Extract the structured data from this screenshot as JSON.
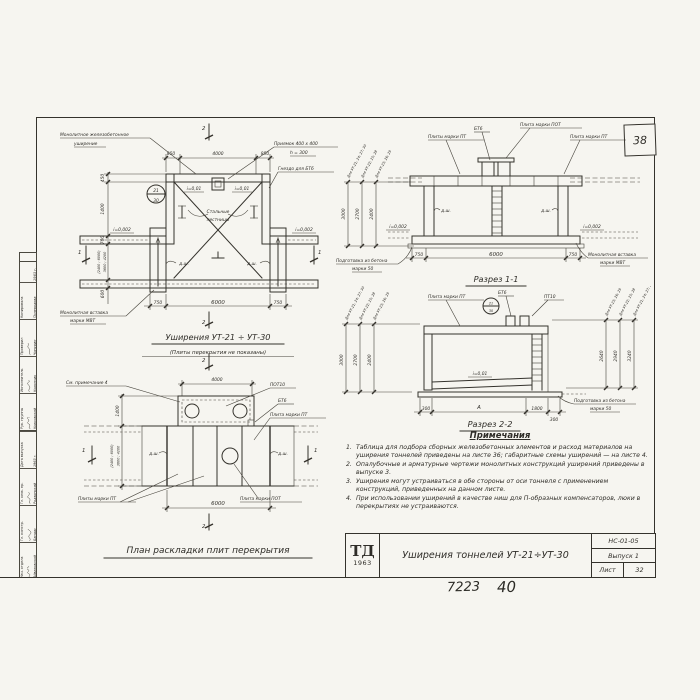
{
  "sheet": {
    "page_number": "38",
    "stamp_number_1": "7223",
    "stamp_number_2": "40"
  },
  "titleblock": {
    "logo": "ТД",
    "logo_year": "1963",
    "title": "Уширения тоннелей УТ-21÷УТ-30",
    "code": "НС-01-05",
    "issue": "Выпуск 1",
    "sheet_label": "Лист",
    "sheet_number": "32"
  },
  "stamp_sidebar": {
    "block_bottom": {
      "rows": [
        {
          "role": "Нач. отдела",
          "name": "Айвазовский"
        },
        {
          "role": "Гл. констр.",
          "name": "Бандас"
        },
        {
          "role": "Гл. инж. пр.",
          "name": "Родзинский"
        },
        {
          "role": "Дата выпуска",
          "name": "1963 г."
        }
      ]
    },
    "block_top": {
      "rows": [
        {
          "role": "Рук. группы",
          "name": "Красовский"
        },
        {
          "role": "Исполнитель",
          "name": "Корончик"
        },
        {
          "role": "Проверил",
          "name": "Чипурин"
        },
        {
          "role": "Копировала",
          "name": "Полеводова"
        }
      ],
      "year": "1963 г."
    }
  },
  "plan_top": {
    "title": "Уширения УТ-21 ÷ УТ-30",
    "subtitle": "(Плиты перекрытия не показаны)",
    "labels": {
      "monolithic_1": "Монолитное железобетонное",
      "monolithic_2": "уширение",
      "pit_1": "Приямок 400 х 400",
      "pit_2": "h = 300",
      "socket": "Гнездо для БТ6",
      "stairs_1": "Стальные",
      "stairs_2": "лестницы",
      "insert_1": "Монолитная вставка",
      "insert_2": "марки МВТ",
      "slope_a": "i=0,01",
      "slope_b": "i=0,01",
      "slope_c": "i=0,002",
      "slope_d": "i=0,002",
      "joint": "д.ш.",
      "mark_top": "21",
      "mark_bottom": "30"
    },
    "dims": {
      "top": [
        "850",
        "4000",
        "850"
      ],
      "bottom": [
        "750",
        "6000",
        "750"
      ],
      "left": [
        "450",
        "1400",
        "700",
        "(2400 ; 6000)",
        "3600 ; 4200",
        "600"
      ]
    },
    "marks": {
      "section_2": "2",
      "section_1": "1"
    }
  },
  "section_1": {
    "title": "Разрез 1-1",
    "labels": {
      "bt6": "БТ6",
      "plate_pot": "Плита марки ПОТ",
      "plates_pt": "Плиты марки ПТ",
      "plate_pt": "Плита марки ПТ",
      "prep_1": "Подготовка из бетона",
      "prep_2": "марки 50",
      "insert_1": "Монолитная вставка",
      "insert_2": "марки МВТ",
      "joint": "д.ш.",
      "slope": "i=0,002"
    },
    "dims": {
      "bottom": [
        "750",
        "6000",
        "750"
      ]
    },
    "height_dims": [
      {
        "for": "Для УТ-21; 24; 27; 30",
        "value": "3000"
      },
      {
        "for": "Для УТ-22; 25; 28",
        "value": "2700"
      },
      {
        "for": "Для УТ-23; 26; 29",
        "value": "2400"
      }
    ]
  },
  "section_2": {
    "title": "Разрез 2-2",
    "labels": {
      "plate_pt": "Плита марки ПТ",
      "bt6": "БТ6",
      "pt10": "ПТ10",
      "slope": "i=0,01",
      "prep_1": "Подготовка из бетона",
      "prep_2": "марки 50",
      "mark_top": "21",
      "mark_bottom": "30"
    },
    "dims": {
      "bottom": [
        "300",
        "А",
        "1800",
        "300"
      ]
    },
    "height_dims_left": [
      {
        "for": "Для УТ-21; 24; 27; 30",
        "value": "3000"
      },
      {
        "for": "Для УТ-22; 25; 28",
        "value": "2700"
      },
      {
        "for": "Для УТ-23; 26; 29",
        "value": "2400"
      }
    ],
    "height_dims_right": [
      {
        "for": "Для УТ-23; 26; 29",
        "value": "2640"
      },
      {
        "for": "Для УТ-22; 25; 28",
        "value": "2940"
      },
      {
        "for": "Для УТ-21; 24; 27; 30",
        "value": "3240"
      }
    ]
  },
  "plan_bottom": {
    "title": "План раскладки плит перекрытия",
    "labels": {
      "see_note": "См. примечание 4",
      "pot10": "ПОТ10",
      "bt6": "БТ6",
      "plate_pt": "Плита марки ПТ",
      "plates_pt": "Плиты марки ПТ",
      "plate_pot": "Плита марки ПОТ",
      "joint": "д.ш."
    },
    "dims": {
      "top": "4000",
      "bottom": "6000",
      "left": [
        "1400",
        "(2400 ; 6000)",
        "3600 ; 4200"
      ]
    },
    "marks": {
      "section_2": "2",
      "section_1": "1"
    }
  },
  "notes": {
    "heading": "Примечания",
    "items": [
      {
        "num": "1.",
        "text": "Таблица для подбора сборных железобетонных элементов и расход материалов на уширения тоннелей приведены на листе 36; габаритные схемы уширений — на листе 4."
      },
      {
        "num": "2.",
        "text": "Опалубочные и арматурные чертежи монолитных конструкций уширений приведены в выпуске 3."
      },
      {
        "num": "3.",
        "text": "Уширения могут устраиваться в обе стороны от оси тоннеля с применением конструкций, приведенных на данном листе."
      },
      {
        "num": "4.",
        "text": "При использовании уширений в качестве ниш для П-образных компенсаторов, люки в перекрытиях не устраиваются."
      }
    ]
  }
}
